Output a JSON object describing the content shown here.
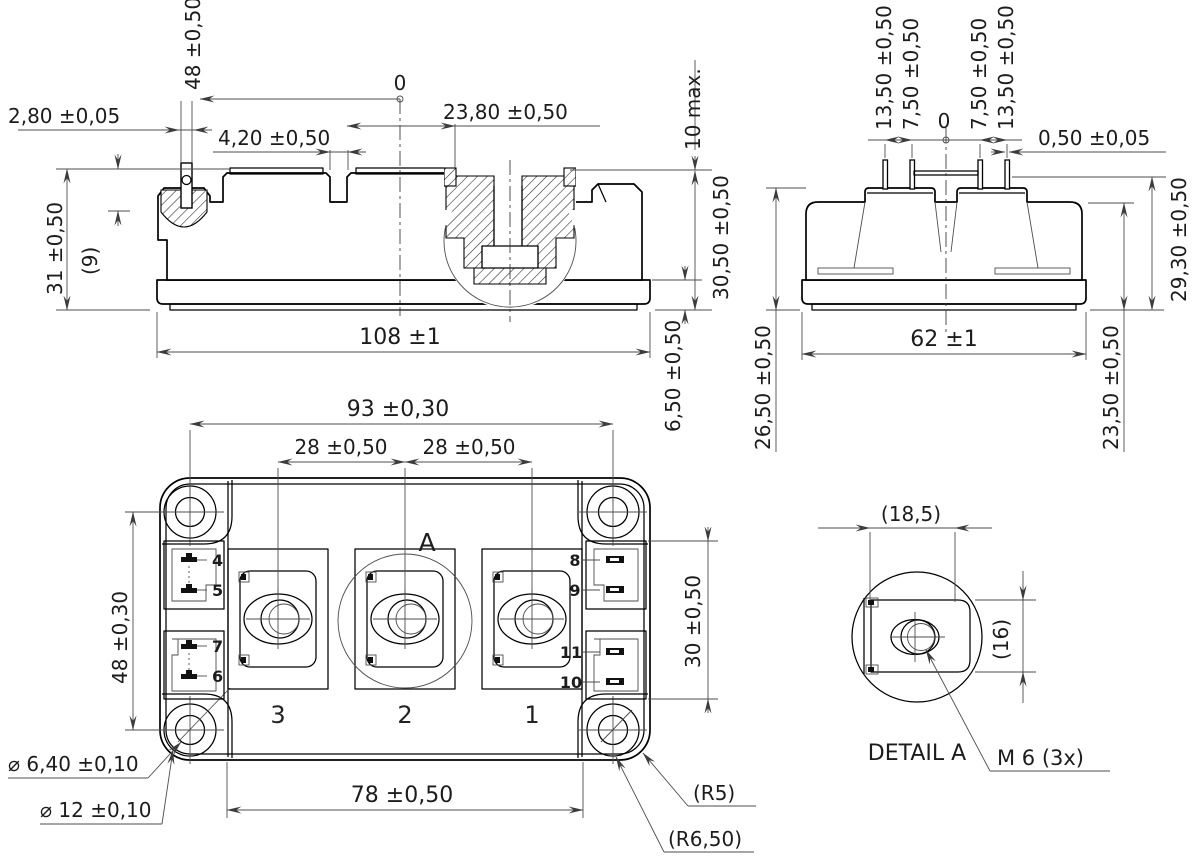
{
  "front_view": {
    "dims": {
      "pin_position": "48 ±0,50",
      "pin_width": "2,80 ±0,05",
      "terminal_gap": "4,20 ±0,50",
      "datum": "0",
      "terminal_width": "23,80 ±0,50",
      "screw_height": "10 max.",
      "height_left": "31 ±0,50",
      "pin_protrusion": "(9)",
      "height_right": "30,50 ±0,50",
      "length": "108 ±1",
      "base_thickness": "6,50 ±0,50"
    }
  },
  "side_view": {
    "dims": {
      "pin_out_left": "13,50 ±0,50",
      "pin_in_left": "7,50 ±0,50",
      "datum": "0",
      "pin_in_right": "7,50 ±0,50",
      "pin_out_right": "13,50 ±0,50",
      "pin_thickness": "0,50 ±0,05",
      "height_pin_plane": "29,30 ±0,50",
      "width": "62 ±1",
      "height_rim": "26,50 ±0,50",
      "height_body": "23,50 ±0,50"
    }
  },
  "plan_view": {
    "dims": {
      "hole_spacing_x": "93 ±0,30",
      "terminal_spacing_a": "28 ±0,50",
      "terminal_spacing_b": "28 ±0,50",
      "hole_spacing_y": "48 ±0,30",
      "connector_span": "30 ±0,50",
      "terminal_span": "78 ±0,50",
      "hole_diameter": "⌀ 6,40 ±0,10",
      "boss_diameter": "⌀ 12 ±0,10",
      "corner_radius_inner": "(R5)",
      "corner_radius_outer": "(R6,50)"
    },
    "terminal_labels": [
      "3",
      "2",
      "1"
    ],
    "pin_labels_left": [
      "4",
      "5",
      "7",
      "6"
    ],
    "pin_labels_right": [
      "8",
      "9",
      "11",
      "10"
    ],
    "detail_marker": "A"
  },
  "detail_view": {
    "title": "DETAIL A",
    "thread_spec": "M 6 (3x)",
    "dims": {
      "width": "(18,5)",
      "height": "(16)"
    }
  }
}
